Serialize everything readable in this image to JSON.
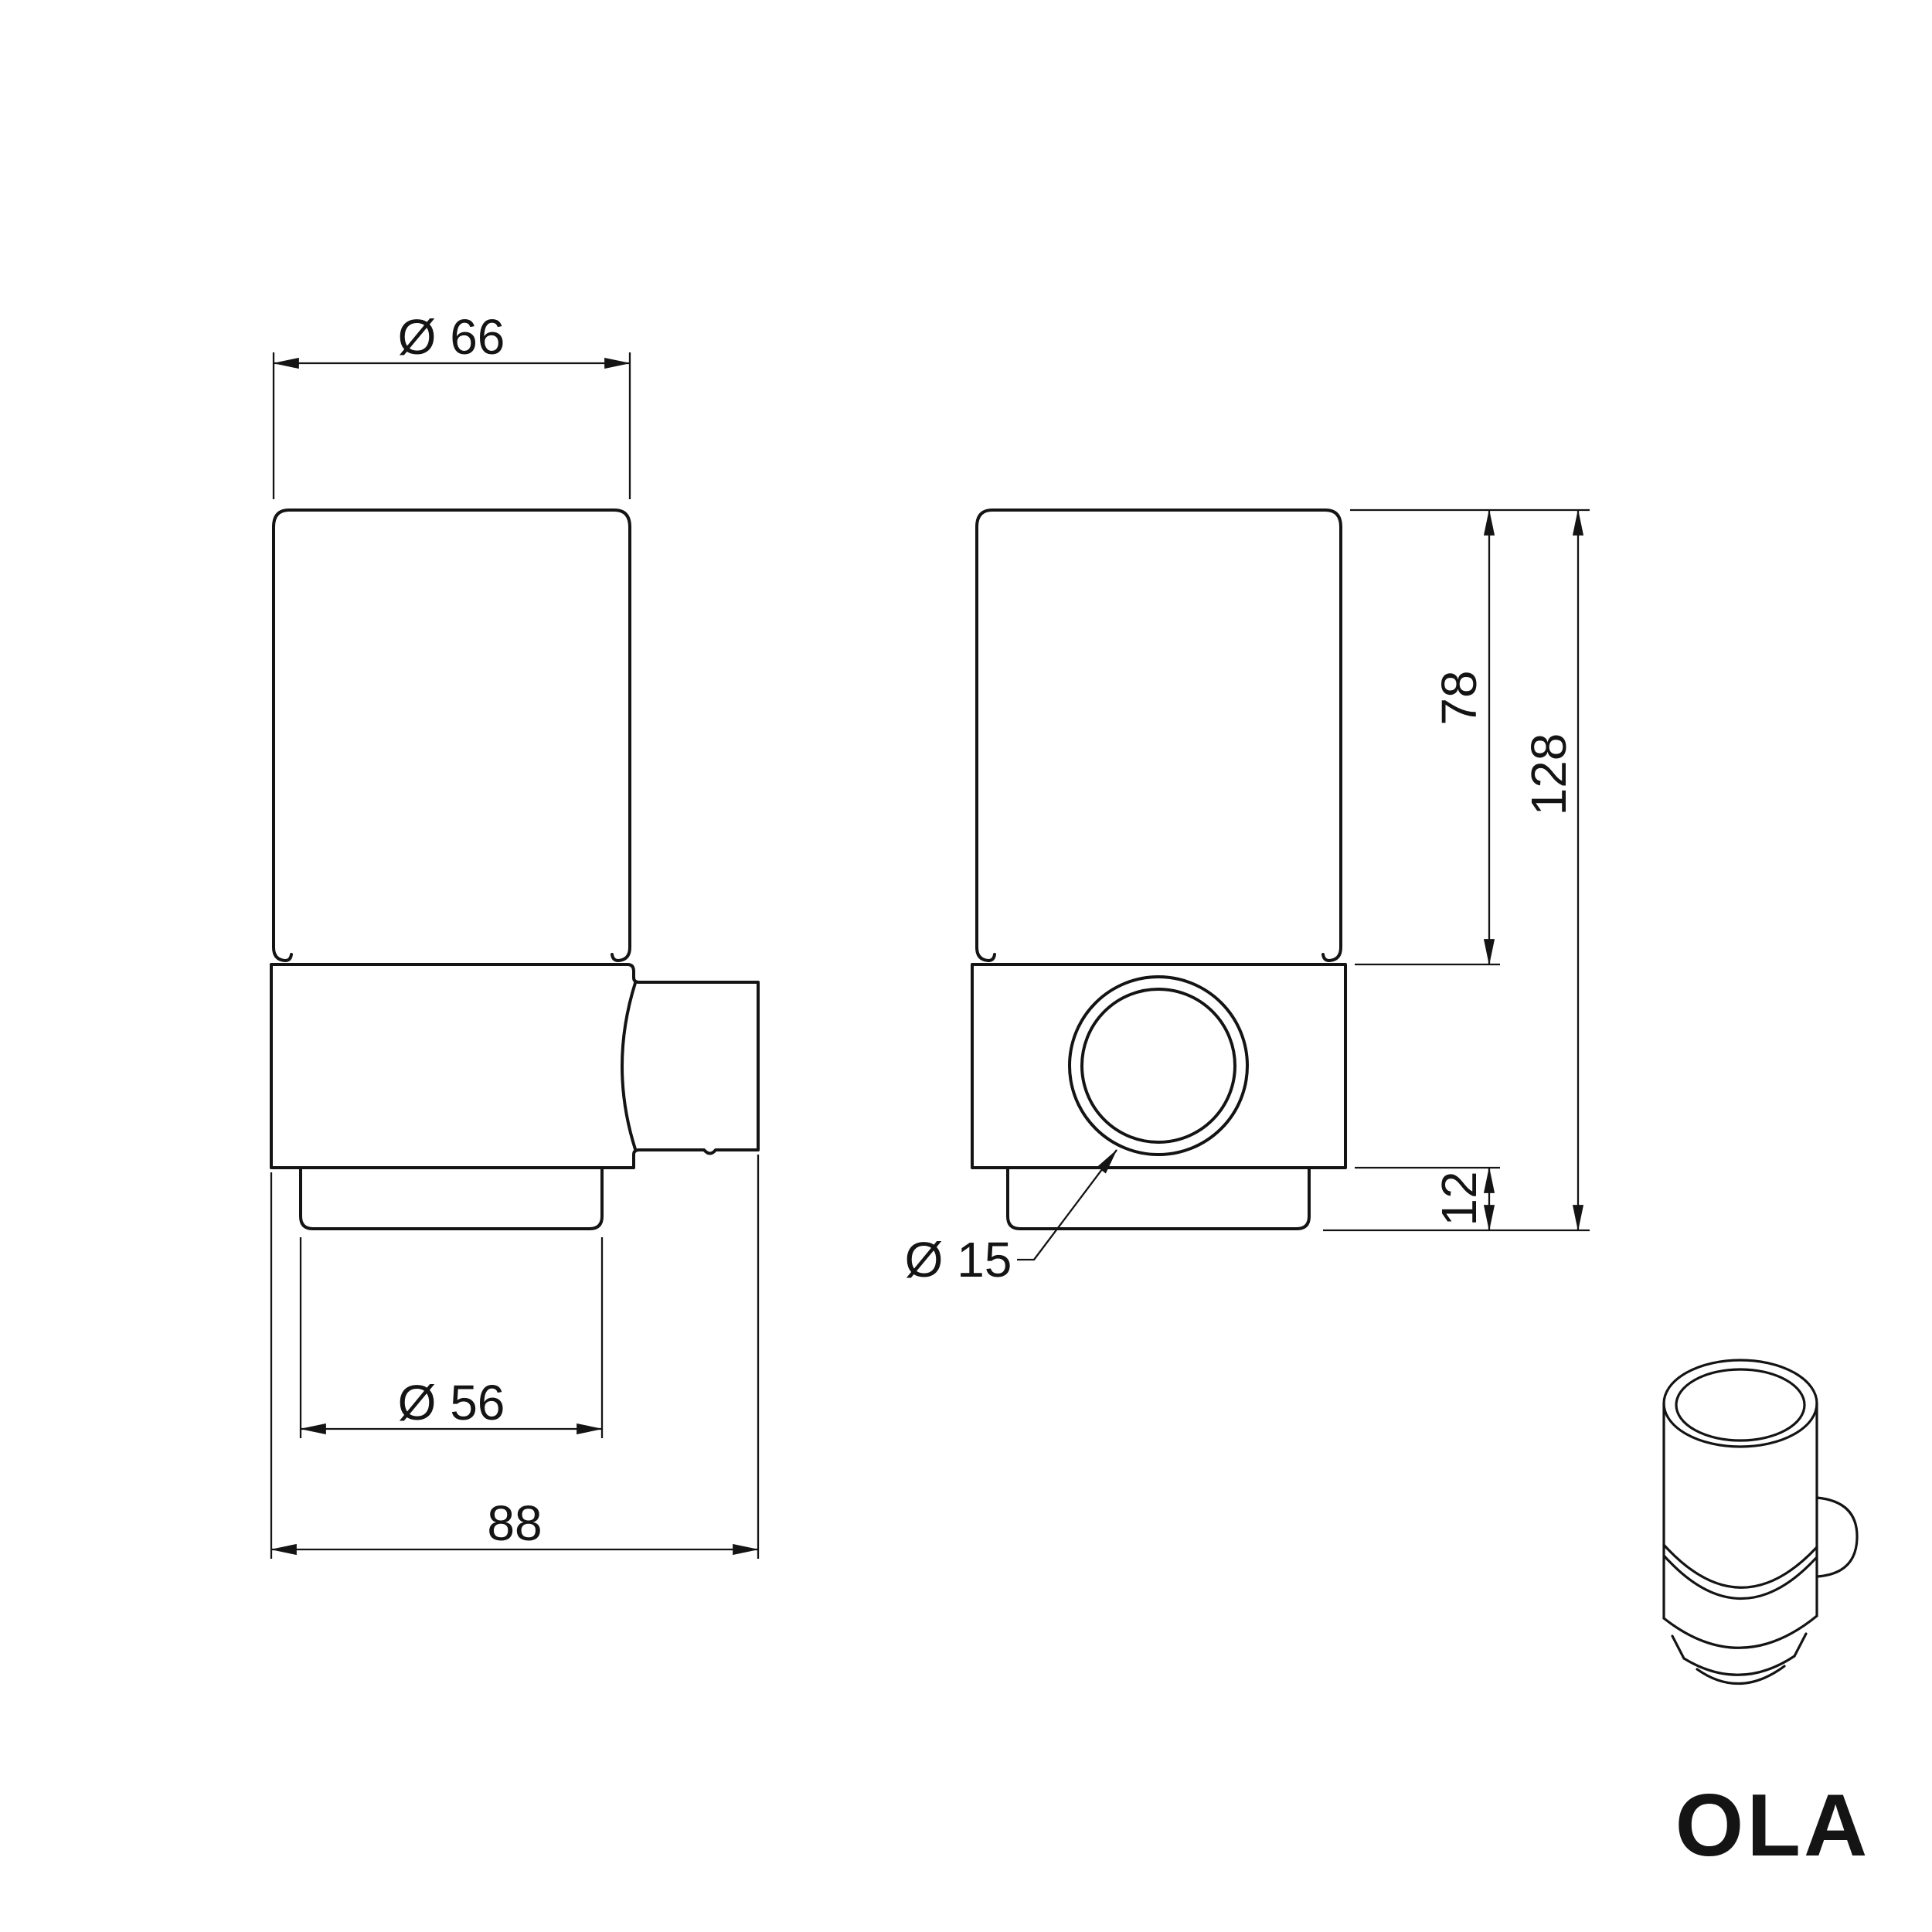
{
  "theme": {
    "bg": "#ffffff",
    "ink": "#141414"
  },
  "drawing": {
    "brand_logo": "OLA",
    "views": {
      "side": {
        "name": "side view of wall-mounted tumbler holder",
        "dims": {
          "top_diameter": "Ø 66",
          "base_diameter": "Ø 56",
          "depth": "88"
        }
      },
      "front": {
        "name": "front view of wall-mounted tumbler holder",
        "dims": {
          "cup_height": "78",
          "total_height": "128",
          "base_height": "12",
          "mount_hole_diameter": "Ø 15"
        }
      },
      "perspective": {
        "name": "perspective thumbnail of tumbler in holder"
      }
    }
  }
}
